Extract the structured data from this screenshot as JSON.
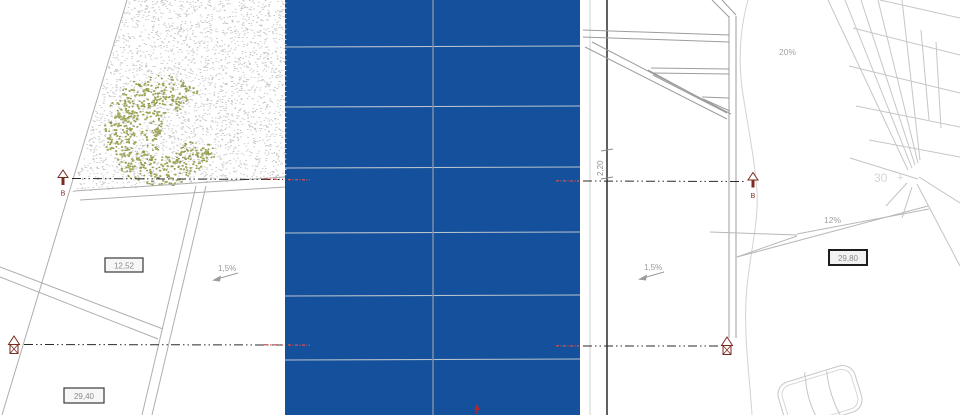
{
  "labels": {
    "slope_left": "1,5%",
    "slope_right": "1,5%",
    "slope_upper_right": "20%",
    "slope_mid_right": "12%",
    "dim_box_left_upper": "12,52",
    "dim_box_left_lower": "29,40",
    "dim_box_right": "29,80",
    "dim_height": "2,20",
    "station_number": "30",
    "station_cross": "+",
    "section_letter_left": "B",
    "section_letter_right": "B"
  },
  "colors": {
    "panel_blue": "#14509c",
    "panel_joint_gray": "#7e93aa",
    "panel_row_line": "#b9c3cd",
    "marker_maroon": "#7d2a1f",
    "annotation_red": "#c42222",
    "vegetation_olive": "#99a14f",
    "cad_line_gray": "#b0b0b0",
    "dark_line_gray": "#4f4f4f"
  }
}
